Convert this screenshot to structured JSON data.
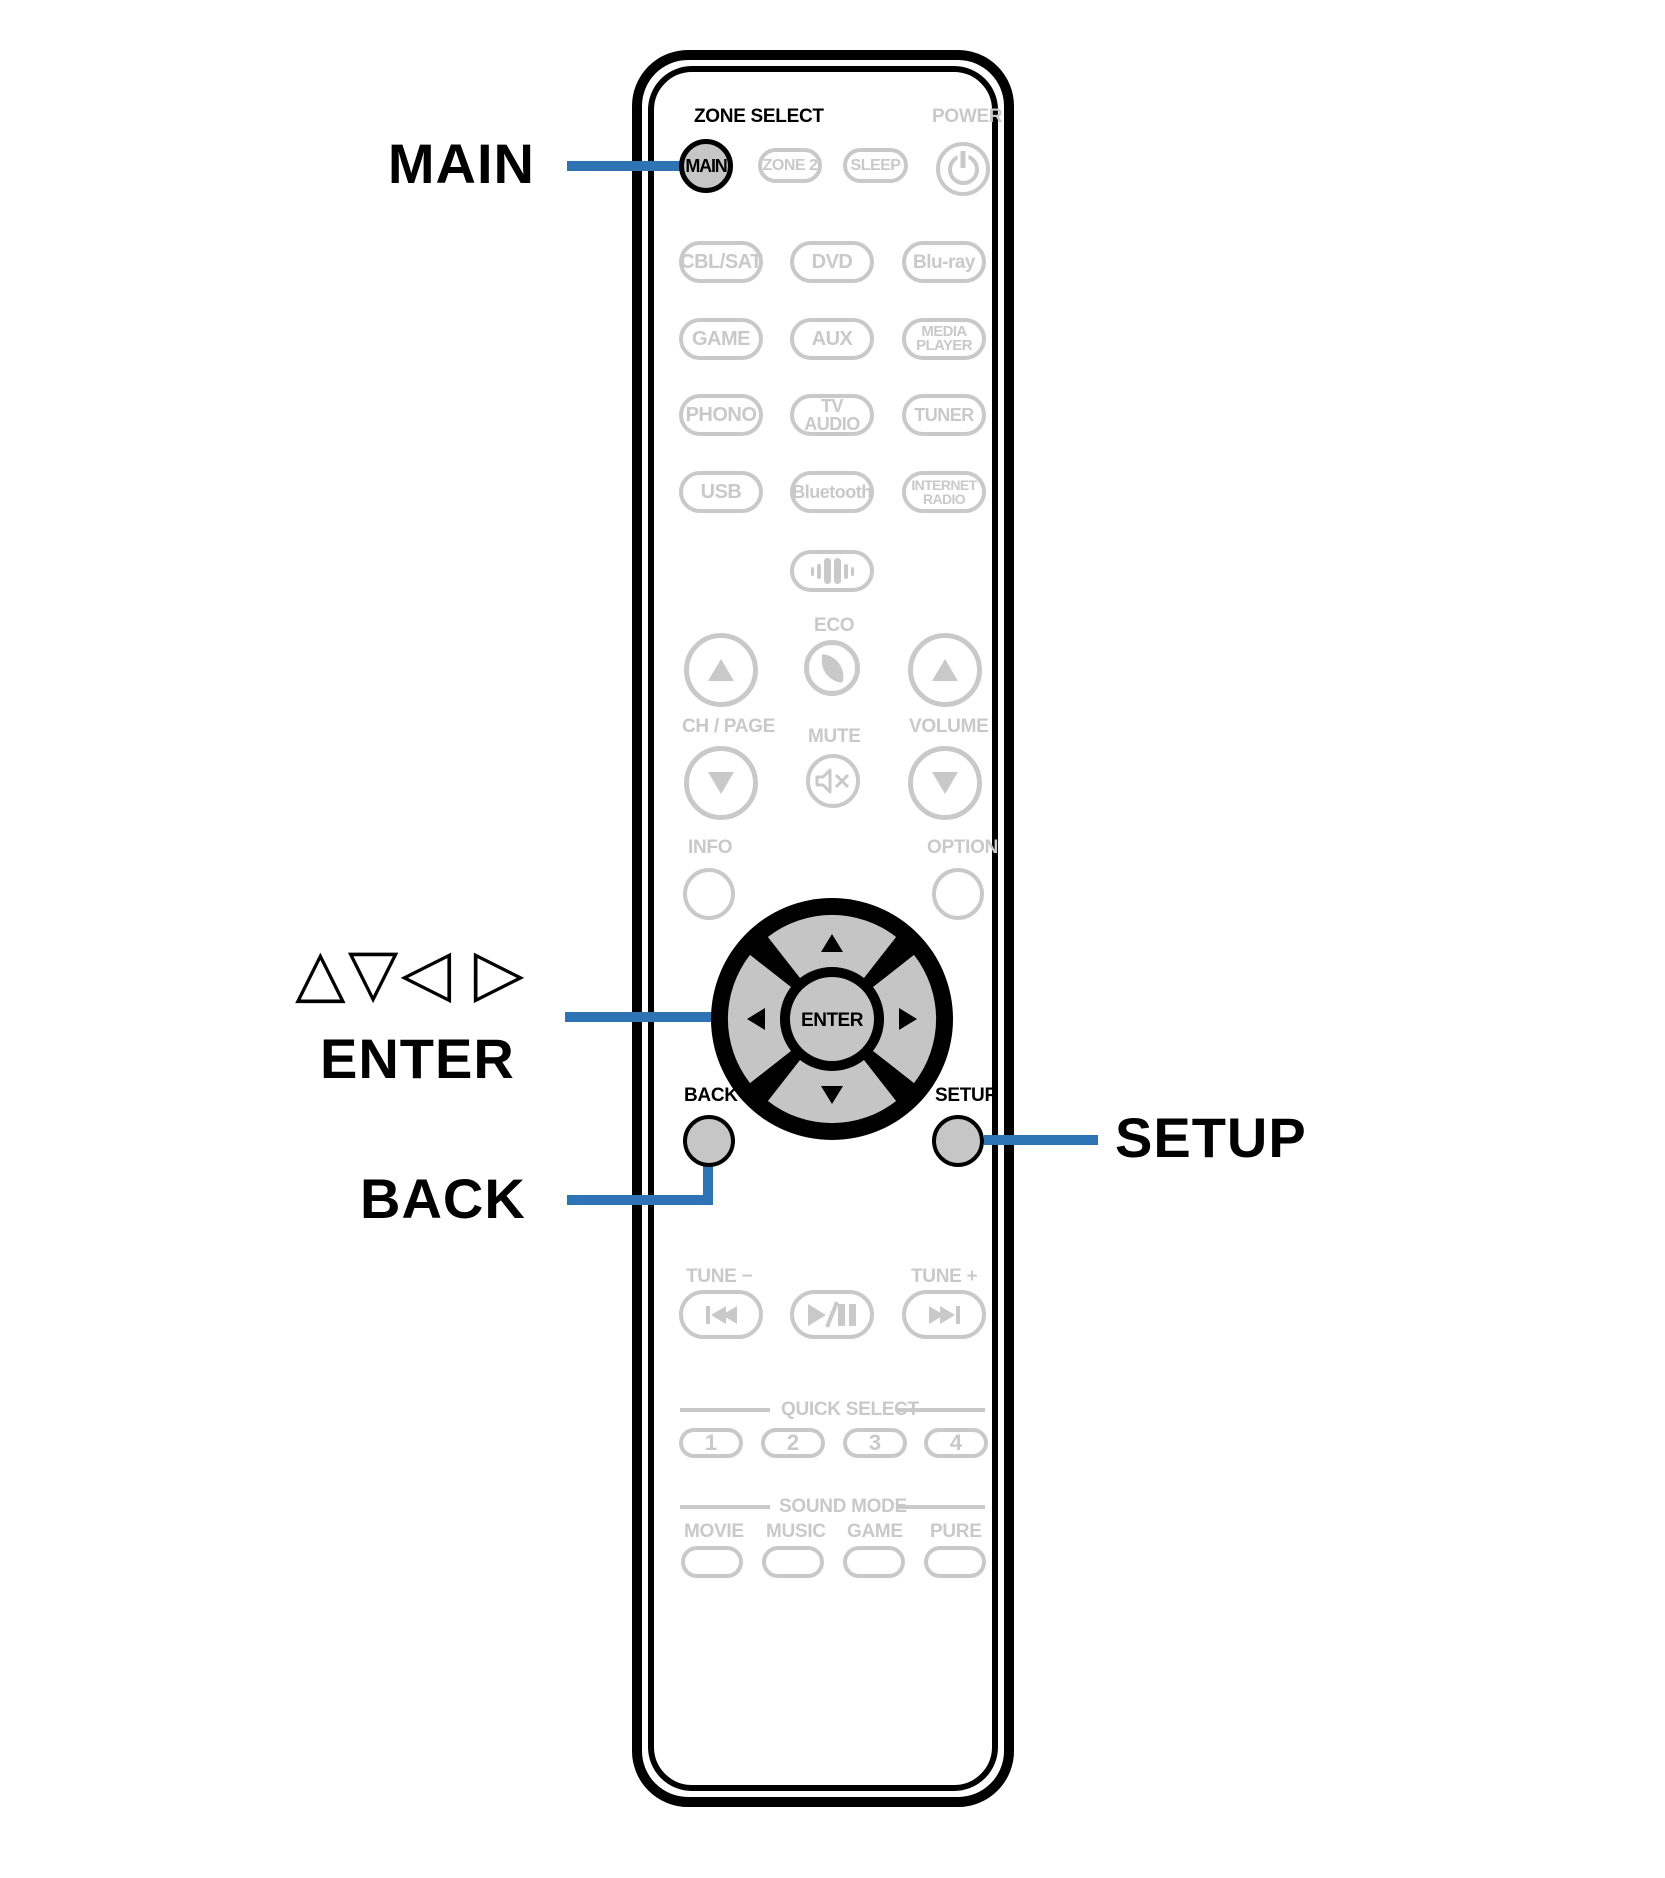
{
  "colors": {
    "accent_blue": "#2e74b5",
    "faded_gray": "#c9c9c9",
    "key_fill": "#c6c6c6",
    "outline_black": "#000000"
  },
  "callouts": {
    "main": "MAIN",
    "cursor_glyphs": "△▽◁ ▷",
    "enter": "ENTER",
    "back": "BACK",
    "setup": "SETUP"
  },
  "remote": {
    "zone_select_label": "ZONE SELECT",
    "power_label": "POWER",
    "main_button": "MAIN",
    "zone2_button": "ZONE 2",
    "sleep_button": "SLEEP",
    "sources": [
      [
        "CBL/SAT",
        "DVD",
        "Blu-ray"
      ],
      [
        "GAME",
        "AUX",
        "MEDIA PLAYER"
      ],
      [
        "PHONO",
        "TV AUDIO",
        "TUNER"
      ],
      [
        "USB",
        "Bluetooth",
        "INTERNET RADIO"
      ]
    ],
    "eco_label": "ECO",
    "ch_page_label": "CH / PAGE",
    "mute_label": "MUTE",
    "volume_label": "VOLUME",
    "info_label": "INFO",
    "option_label": "OPTION",
    "enter_button": "ENTER",
    "back_label": "BACK",
    "setup_label": "SETUP",
    "tune_minus_label": "TUNE −",
    "tune_plus_label": "TUNE +",
    "quick_select_label": "QUICK SELECT",
    "quick_select_buttons": [
      "1",
      "2",
      "3",
      "4"
    ],
    "sound_mode_label": "SOUND MODE",
    "sound_mode_names": [
      "MOVIE",
      "MUSIC",
      "GAME",
      "PURE"
    ],
    "icons": {
      "power": "power-symbol",
      "audio_setup": "sound-bars",
      "eco": "leaf",
      "mute": "speaker-muted",
      "ch_up": "up-triangle",
      "ch_down": "down-triangle",
      "volume_up": "up-triangle",
      "volume_down": "down-triangle",
      "cursor_pad": "up-down-left-right-triangles",
      "skip_back": "prev-track",
      "play_pause": "play-pause",
      "skip_forward": "next-track"
    }
  }
}
